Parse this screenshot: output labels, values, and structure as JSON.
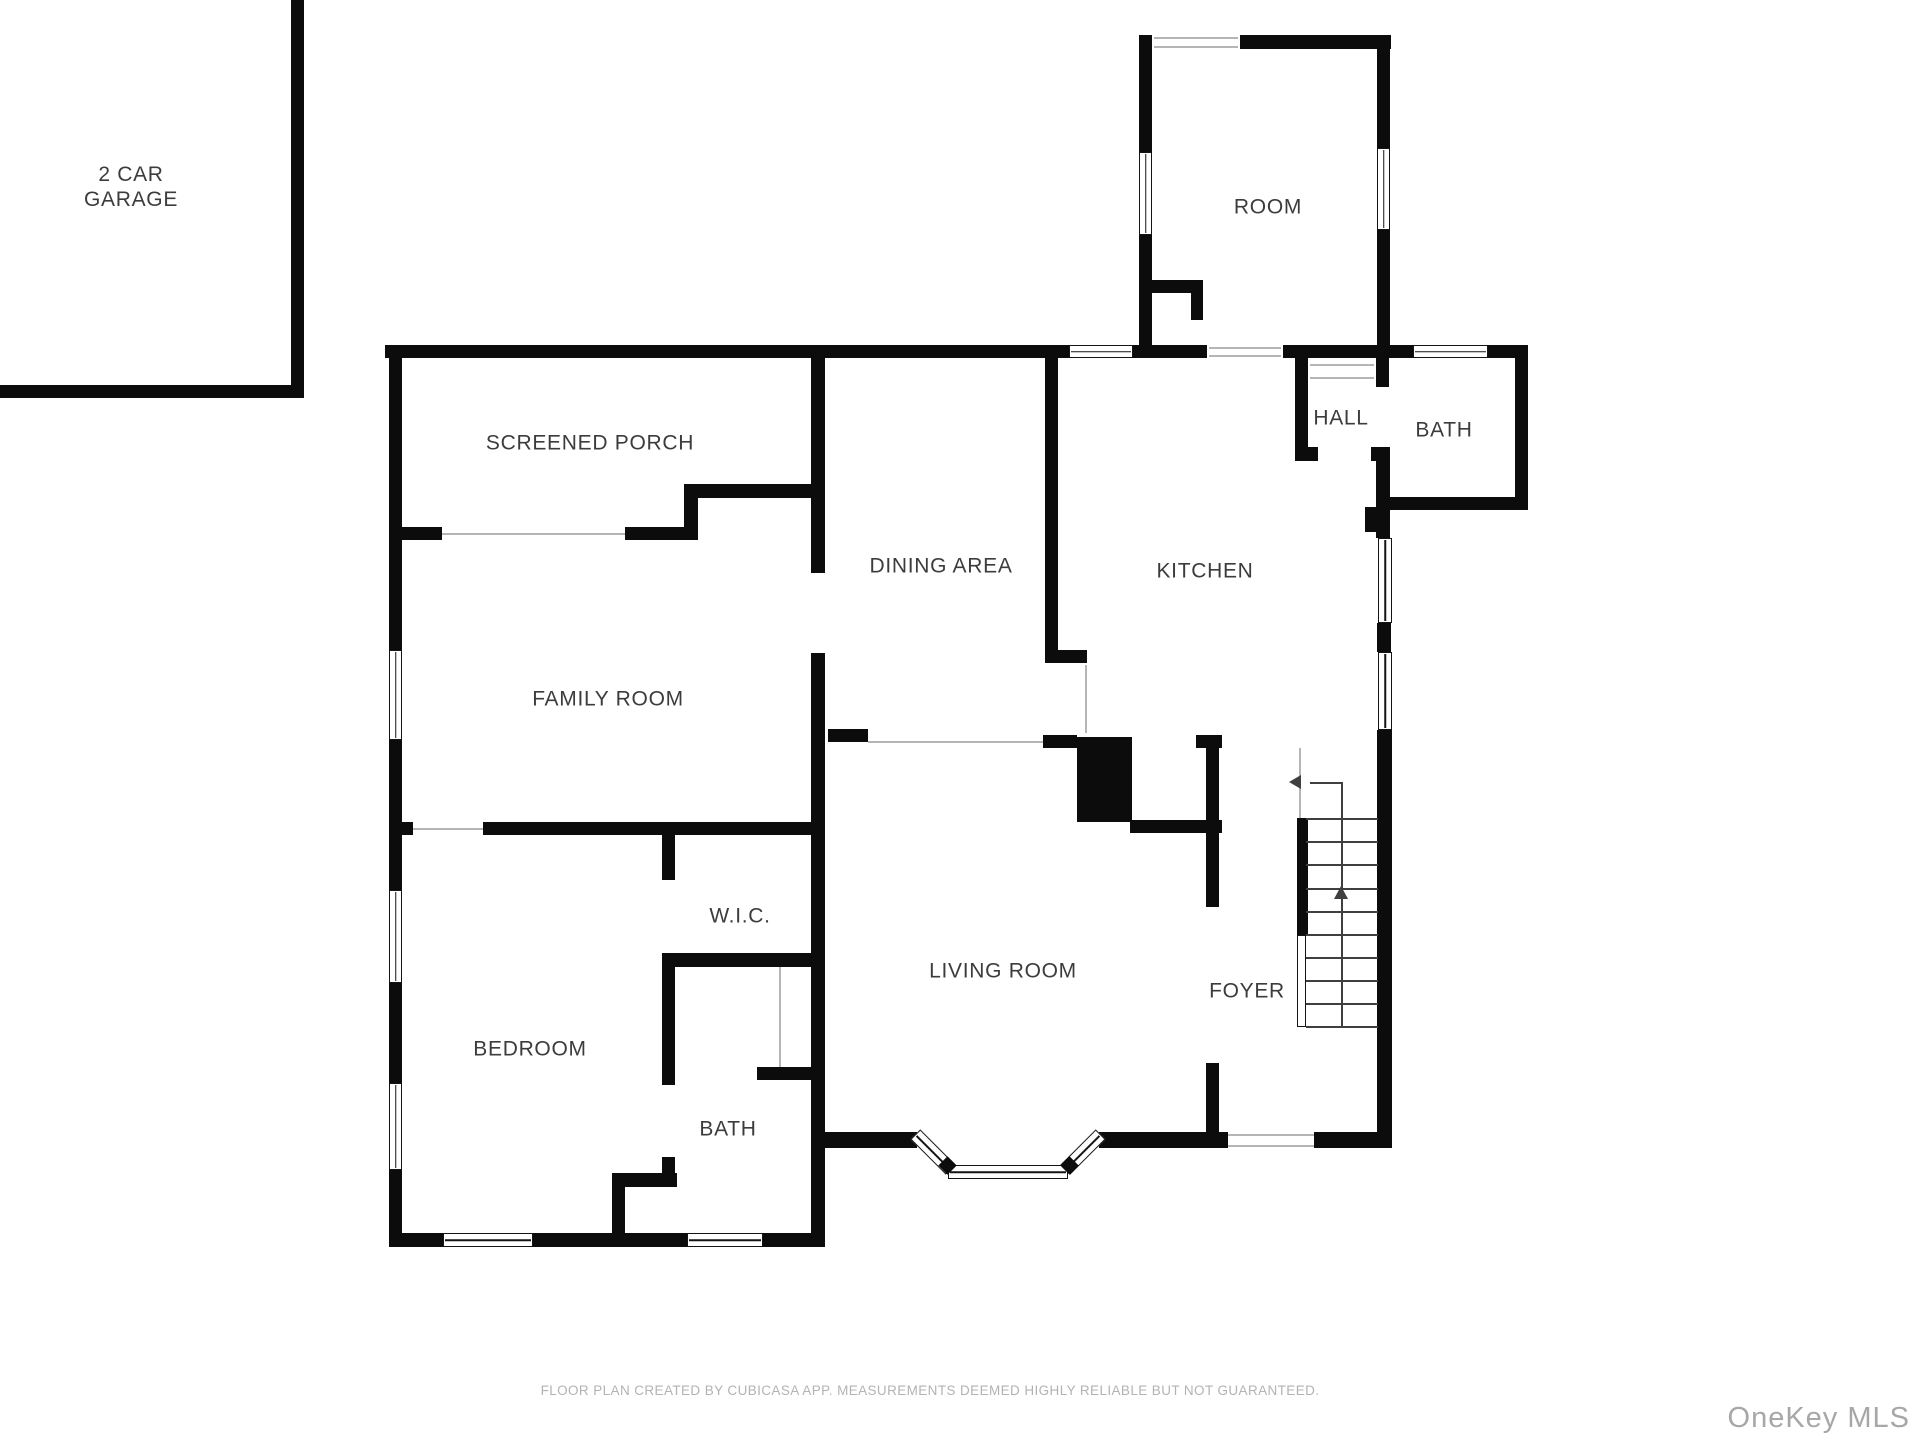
{
  "colors": {
    "wall": "#0c0c0c",
    "label": "#3c3c3c",
    "threshold": "#b5b5b5",
    "muted": "#b3b3b3",
    "watermark": "#a7a7a7"
  },
  "footer": {
    "disclaimer": "FLOOR PLAN CREATED BY CUBICASA APP. MEASUREMENTS DEEMED HIGHLY RELIABLE BUT NOT GUARANTEED.",
    "watermark": "OneKey MLS"
  },
  "plan": {
    "labels": [
      {
        "id": "garage",
        "text": "2 CAR\nGARAGE",
        "x": 131,
        "y": 188
      },
      {
        "id": "room",
        "text": "ROOM",
        "x": 1268,
        "y": 208
      },
      {
        "id": "screened-porch",
        "text": "SCREENED PORCH",
        "x": 590,
        "y": 444
      },
      {
        "id": "dining-area",
        "text": "DINING AREA",
        "x": 941,
        "y": 567
      },
      {
        "id": "kitchen",
        "text": "KITCHEN",
        "x": 1205,
        "y": 572
      },
      {
        "id": "hall",
        "text": "HALL",
        "x": 1341,
        "y": 419
      },
      {
        "id": "bath-upper",
        "text": "BATH",
        "x": 1444,
        "y": 431
      },
      {
        "id": "family-room",
        "text": "FAMILY ROOM",
        "x": 608,
        "y": 700
      },
      {
        "id": "wic",
        "text": "W.I.C.",
        "x": 740,
        "y": 917
      },
      {
        "id": "bedroom",
        "text": "BEDROOM",
        "x": 530,
        "y": 1050
      },
      {
        "id": "bath-lower",
        "text": "BATH",
        "x": 728,
        "y": 1130
      },
      {
        "id": "living-room",
        "text": "LIVING ROOM",
        "x": 1003,
        "y": 972
      },
      {
        "id": "foyer",
        "text": "FOYER",
        "x": 1247,
        "y": 992
      }
    ],
    "walls": [
      [
        291,
        0,
        13,
        397
      ],
      [
        0,
        385,
        304,
        13
      ],
      [
        385,
        345,
        684,
        13
      ],
      [
        1133,
        345,
        74,
        13
      ],
      [
        1283,
        345,
        130,
        13
      ],
      [
        1488,
        345,
        40,
        13
      ],
      [
        1139,
        35,
        13,
        117
      ],
      [
        1139,
        235,
        13,
        110
      ],
      [
        1240,
        35,
        151,
        14
      ],
      [
        1377,
        35,
        13,
        113
      ],
      [
        1377,
        230,
        13,
        115
      ],
      [
        1139,
        280,
        64,
        13
      ],
      [
        1191,
        293,
        12,
        27
      ],
      [
        1295,
        345,
        13,
        116
      ],
      [
        1376,
        358,
        13,
        29
      ],
      [
        1376,
        447,
        14,
        91
      ],
      [
        1295,
        447,
        23,
        14
      ],
      [
        1371,
        447,
        17,
        14
      ],
      [
        1515,
        345,
        13,
        165
      ],
      [
        1388,
        497,
        140,
        13
      ],
      [
        1365,
        507,
        23,
        25
      ],
      [
        1377,
        623,
        14,
        29
      ],
      [
        1377,
        730,
        15,
        418
      ],
      [
        389,
        345,
        13,
        305
      ],
      [
        389,
        740,
        13,
        150
      ],
      [
        389,
        983,
        13,
        100
      ],
      [
        389,
        1170,
        13,
        77
      ],
      [
        389,
        527,
        53,
        13
      ],
      [
        625,
        527,
        73,
        13
      ],
      [
        684,
        498,
        14,
        42
      ],
      [
        684,
        484,
        140,
        14
      ],
      [
        811,
        352,
        14,
        221
      ],
      [
        811,
        653,
        14,
        594
      ],
      [
        389,
        822,
        24,
        13
      ],
      [
        483,
        822,
        341,
        13
      ],
      [
        1045,
        352,
        13,
        300
      ],
      [
        1045,
        650,
        42,
        13
      ],
      [
        828,
        729,
        40,
        13
      ],
      [
        1043,
        735,
        34,
        13
      ],
      [
        1077,
        737,
        55,
        85
      ],
      [
        1130,
        820,
        92,
        13
      ],
      [
        1196,
        735,
        26,
        13
      ],
      [
        1206,
        737,
        13,
        170
      ],
      [
        1206,
        1063,
        13,
        85
      ],
      [
        389,
        1233,
        54,
        14
      ],
      [
        533,
        1233,
        154,
        14
      ],
      [
        763,
        1233,
        62,
        14
      ],
      [
        824,
        1132,
        93,
        16
      ],
      [
        1099,
        1132,
        129,
        16
      ],
      [
        1314,
        1132,
        78,
        16
      ],
      [
        662,
        835,
        13,
        45
      ],
      [
        662,
        953,
        13,
        132
      ],
      [
        662,
        1157,
        13,
        30
      ],
      [
        612,
        1173,
        65,
        14
      ],
      [
        612,
        1187,
        13,
        46
      ],
      [
        662,
        953,
        162,
        14
      ],
      [
        757,
        1067,
        67,
        13
      ],
      [
        1297,
        818,
        11,
        117
      ]
    ],
    "windows": [
      [
        389,
        650,
        13,
        90,
        "v"
      ],
      [
        389,
        890,
        13,
        93,
        "v"
      ],
      [
        389,
        1083,
        13,
        87,
        "v"
      ],
      [
        443,
        1233,
        90,
        14,
        "h"
      ],
      [
        687,
        1233,
        76,
        14,
        "h"
      ],
      [
        1069,
        345,
        64,
        13,
        "h"
      ],
      [
        1413,
        345,
        75,
        13,
        "h"
      ],
      [
        1378,
        538,
        14,
        85,
        "v"
      ],
      [
        1378,
        652,
        14,
        78,
        "v"
      ],
      [
        1139,
        152,
        13,
        83,
        "v"
      ],
      [
        1377,
        148,
        13,
        82,
        "v"
      ],
      [
        948,
        1165,
        120,
        14,
        "h"
      ]
    ],
    "thin_lines": [
      [
        442,
        533,
        183,
        "h"
      ],
      [
        413,
        828,
        70,
        "h"
      ],
      [
        868,
        741,
        175,
        "h"
      ],
      [
        1085,
        665,
        68,
        "v"
      ],
      [
        1228,
        1134,
        86,
        "h"
      ],
      [
        1228,
        1145,
        86,
        "h"
      ],
      [
        1154,
        37,
        84,
        "h"
      ],
      [
        1154,
        46,
        84,
        "h"
      ],
      [
        1310,
        364,
        64,
        "h"
      ],
      [
        1310,
        377,
        64,
        "h"
      ],
      [
        1209,
        347,
        72,
        "h"
      ],
      [
        1209,
        355,
        72,
        "h"
      ],
      [
        779,
        967,
        100,
        "v"
      ],
      [
        1299,
        748,
        70,
        "v"
      ]
    ],
    "stair_treads": {
      "x": 1306,
      "len": 72,
      "ys": [
        818,
        841,
        864,
        888,
        911,
        934,
        957,
        980,
        1003,
        1026
      ]
    },
    "stair_lines": [
      [
        1341,
        782,
        244,
        "v"
      ],
      [
        1310,
        782,
        31,
        "h"
      ]
    ],
    "stair_rail": [
      1297,
      935,
      9,
      92
    ],
    "arrows": [
      {
        "x": 1299,
        "y": 782,
        "dir": "left"
      },
      {
        "x": 1341,
        "y": 888,
        "dir": "up"
      }
    ],
    "diagonals": [
      [
        933,
        1152,
        50,
        45
      ],
      [
        1083,
        1152,
        50,
        -45
      ]
    ],
    "caps": [
      [
        947,
        1165
      ],
      [
        1069,
        1165
      ]
    ]
  }
}
